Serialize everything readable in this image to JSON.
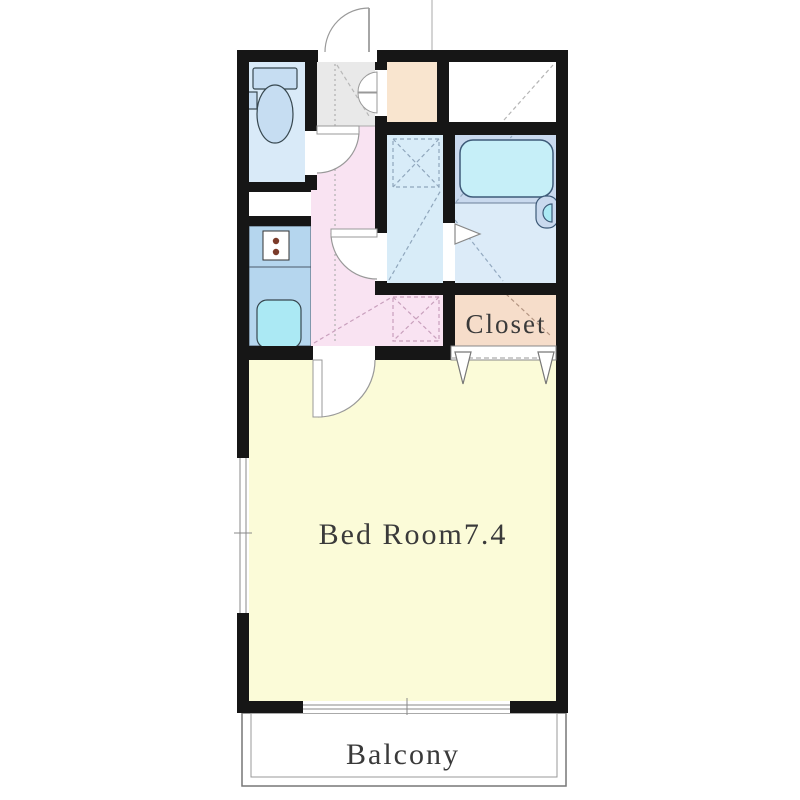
{
  "title": "Apartment floor plan",
  "labels": {
    "bedroom": "Bed Room7.4",
    "closet": "Closet",
    "balcony": "Balcony"
  },
  "colors": {
    "wall": "#161616",
    "toilet_room": "#d9eaf8",
    "toilet_fixture": "#c6ddf2",
    "kitchen": "#b5d6ee",
    "sink": "#abe9f4",
    "entry": "#e9e9e9",
    "hallway": "#f9e3f2",
    "shoe_box": "#f9e5cf",
    "washroom": "#d8ecf8",
    "bath_floor": "#dcebf8",
    "bath_platform": "#c9d9ee",
    "bathtub": "#c6eff8",
    "closet": "#f6ddca",
    "bedroom": "#fbfbd8",
    "balcony": "#ffffff",
    "white_room": "#ffffff"
  }
}
